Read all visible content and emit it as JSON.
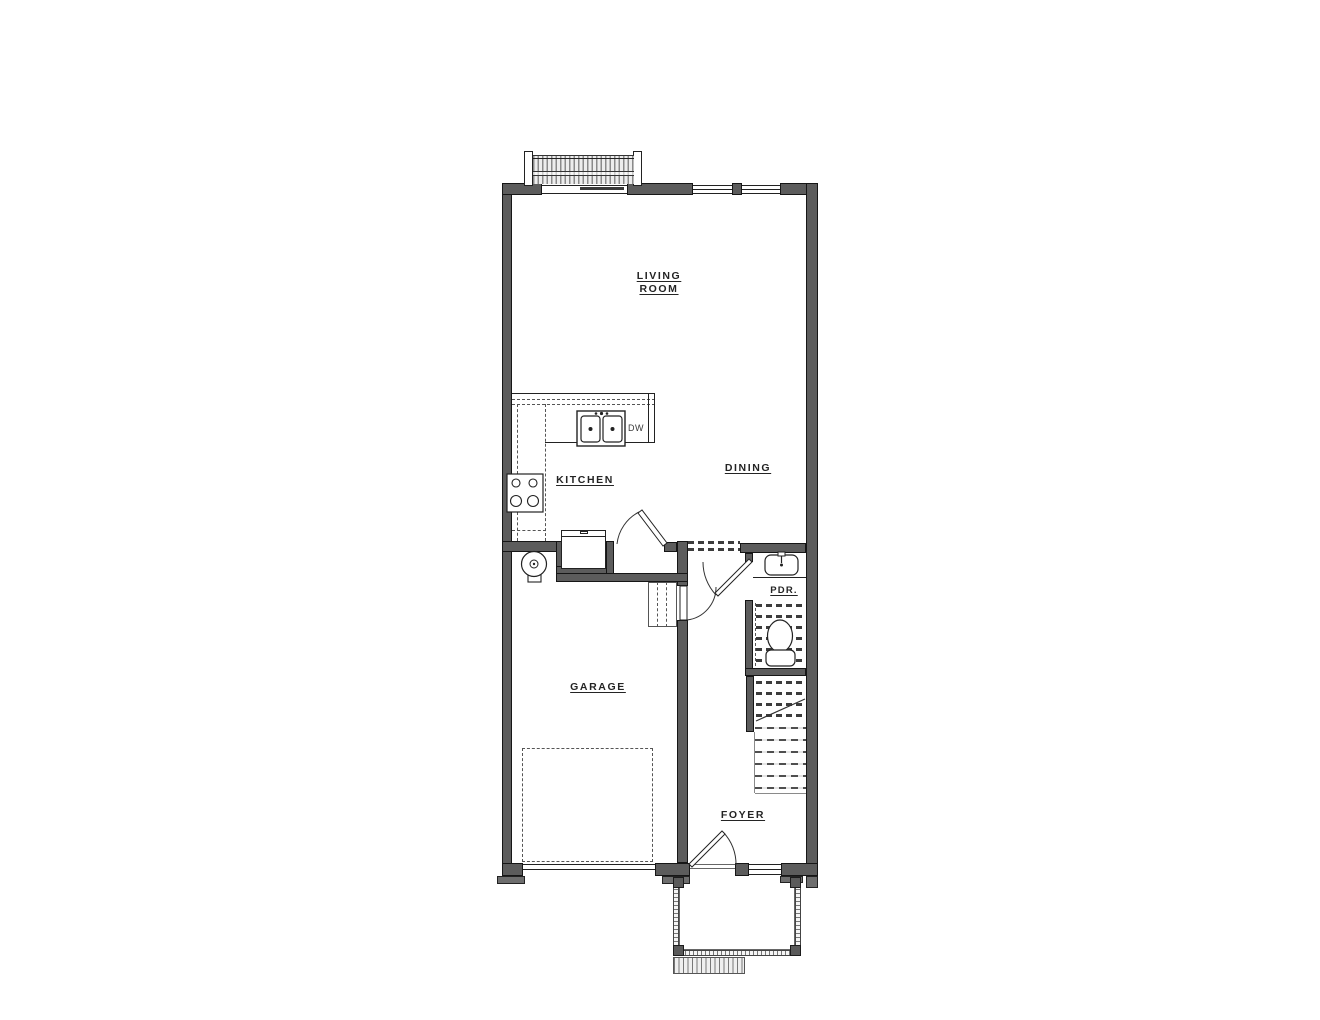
{
  "labels": {
    "living_room_line1": "LIVING",
    "living_room_line2": "ROOM",
    "kitchen": "KITCHEN",
    "dining": "DINING",
    "garage": "GARAGE",
    "foyer": "FOYER",
    "powder_room": "PDR.",
    "dishwasher": "DW"
  },
  "colors": {
    "wall_fill": "#5c5c5c",
    "wall_edge": "#161616",
    "line": "#222222",
    "background": "#ffffff"
  }
}
